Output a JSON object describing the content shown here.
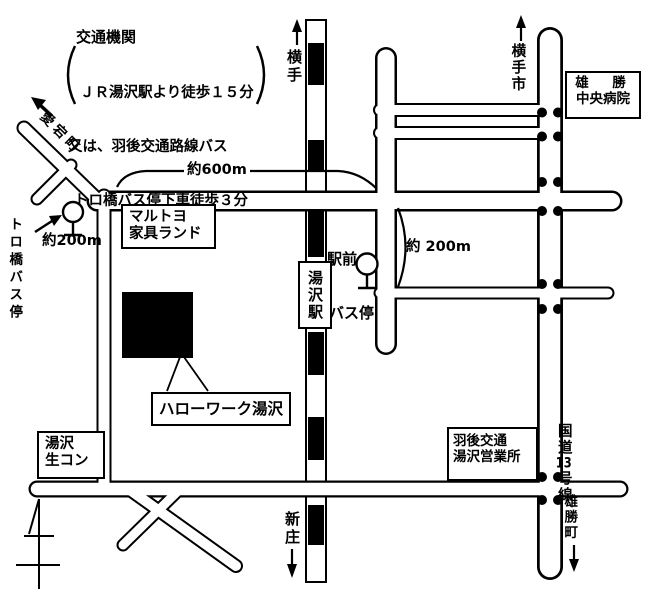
{
  "info_note": {
    "title": "交通機関",
    "lines": [
      "ＪＲ湯沢駅より徒歩１５分",
      "又は、羽後交通路線バス",
      "トロ橋バス停下車徒歩３分"
    ]
  },
  "destinations": {
    "north_rail": "横手",
    "north_road": "横手市",
    "south_rail": "新庄",
    "south_road": "雄勝町",
    "northwest_road": "愛宕町"
  },
  "station": {
    "name": "湯沢駅"
  },
  "bus": {
    "ekimae_line1": "駅前",
    "ekimae_line2": "バス停",
    "torobashi": "トロ橋バス停"
  },
  "distances": {
    "to_station_600": "約600m",
    "to_torobashi_200": "約200m",
    "to_route13_200": "約 200m"
  },
  "landmarks": {
    "furniture_line1": "マルトヨ",
    "furniture_line2": "家具ランド",
    "hellowork": "ハローワーク湯沢",
    "concrete_line1": "湯沢",
    "concrete_line2": "生コン",
    "bus_office_line1": "羽後交通",
    "bus_office_line2": "湯沢営業所",
    "hospital_line1": "雄　勝",
    "hospital_line2": "中央病院"
  },
  "roads": {
    "route13_pre": "国道",
    "route13_num": "13",
    "route13_post": "号線"
  },
  "icons": {
    "bus_stop": "lollipop-bus-stop-sign",
    "north_arrow": "survey-north-arrow",
    "railway": "black-white-striped-rail-bar",
    "signals": "paired-black-dots"
  },
  "colors": {
    "ink": "#000000",
    "paper": "#ffffff"
  }
}
